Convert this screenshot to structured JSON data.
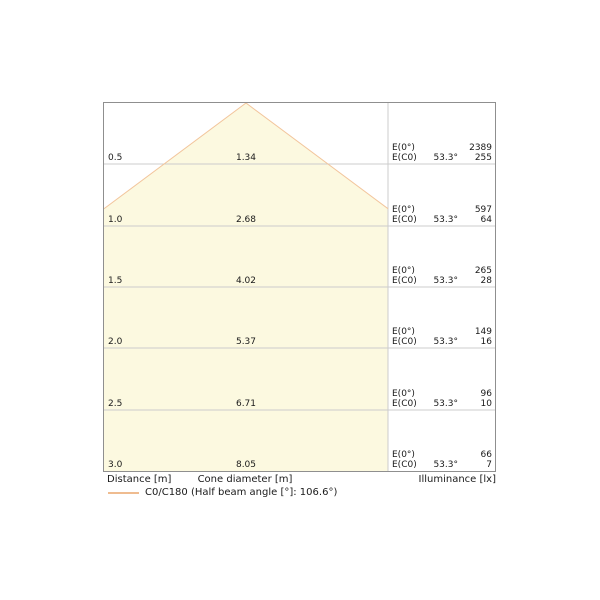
{
  "chart": {
    "rows": [
      {
        "distance": "0.5",
        "diameter": "1.34",
        "e0_label": "E(0°)",
        "ec0_label": "E(C0)",
        "angle": "53.3°",
        "e0": "2389",
        "ec0": "255"
      },
      {
        "distance": "1.0",
        "diameter": "2.68",
        "e0_label": "E(0°)",
        "ec0_label": "E(C0)",
        "angle": "53.3°",
        "e0": "597",
        "ec0": "64"
      },
      {
        "distance": "1.5",
        "diameter": "4.02",
        "e0_label": "E(0°)",
        "ec0_label": "E(C0)",
        "angle": "53.3°",
        "e0": "265",
        "ec0": "28"
      },
      {
        "distance": "2.0",
        "diameter": "5.37",
        "e0_label": "E(0°)",
        "ec0_label": "E(C0)",
        "angle": "53.3°",
        "e0": "149",
        "ec0": "16"
      },
      {
        "distance": "2.5",
        "diameter": "6.71",
        "e0_label": "E(0°)",
        "ec0_label": "E(C0)",
        "angle": "53.3°",
        "e0": "96",
        "ec0": "10"
      },
      {
        "distance": "3.0",
        "diameter": "8.05",
        "e0_label": "E(0°)",
        "ec0_label": "E(C0)",
        "angle": "53.3°",
        "e0": "66",
        "ec0": "7"
      }
    ],
    "footer": {
      "distance": "Distance [m]",
      "cone_diameter": "Cone diameter [m]",
      "illuminance": "Illuminance [lx]"
    },
    "legend": {
      "label": "C0/C180 (Half beam angle [°]: 106.6°)",
      "swatch_color": "#efbc90"
    },
    "colors": {
      "cone_fill": "#fcf9e0",
      "cone_edge": "#f2c59c",
      "gridline": "#cccccc",
      "border": "#8f8f8f"
    }
  },
  "chart_data": {
    "type": "area",
    "title": "Light cone diagram (C0/C180)",
    "distances_m": [
      0.5,
      1.0,
      1.5,
      2.0,
      2.5,
      3.0
    ],
    "cone_diameter_m": [
      1.34,
      2.68,
      4.02,
      5.37,
      6.71,
      8.05
    ],
    "illuminance_E0_lx": [
      2389,
      597,
      265,
      149,
      96,
      66
    ],
    "illuminance_EC0_lx": [
      255,
      64,
      28,
      16,
      10,
      7
    ],
    "half_angle_deg": 53.3,
    "half_beam_angle_deg": 106.6,
    "legend": "C0/C180 (Half beam angle [°]: 106.6°)",
    "xlabel": "Cone diameter [m]",
    "ylabel": "Distance [m]",
    "y2label": "Illuminance [lx]",
    "ylim": [
      0,
      3.0
    ],
    "grid": true,
    "legend_position": "bottom-left"
  }
}
